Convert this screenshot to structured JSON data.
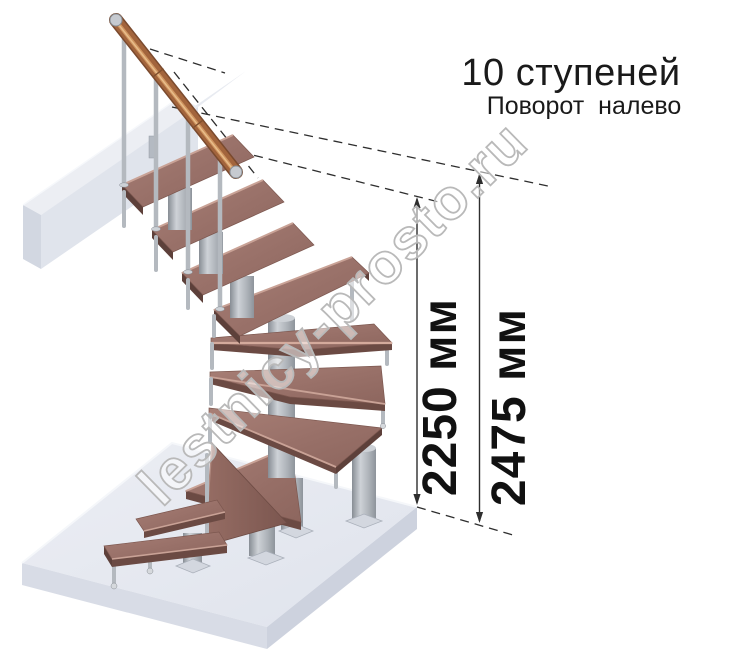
{
  "header": {
    "title": "10 ступеней",
    "subtitle": "Поворот налево"
  },
  "dimensions": {
    "inner": {
      "label": "2250 мм",
      "value": 2250,
      "unit": "мм"
    },
    "outer": {
      "label": "2475 мм",
      "value": 2475,
      "unit": "мм"
    }
  },
  "watermark": {
    "text": "lestnicy-prosto.ru"
  },
  "figure": {
    "steps_count": 10,
    "turn_direction": "налево"
  },
  "colors": {
    "wood": "#9c746c",
    "wood_edge_highlight": "#d4aa9c",
    "wood_shadow": "#6b4a43",
    "metal": "#b4b9bf",
    "handrail_copper": "#a2643c",
    "platform_gray": "#e6e9f0",
    "dimension_line": "#2e2e2e",
    "text": "#1a1a1a",
    "watermark_outline": "#b9b9b9"
  }
}
